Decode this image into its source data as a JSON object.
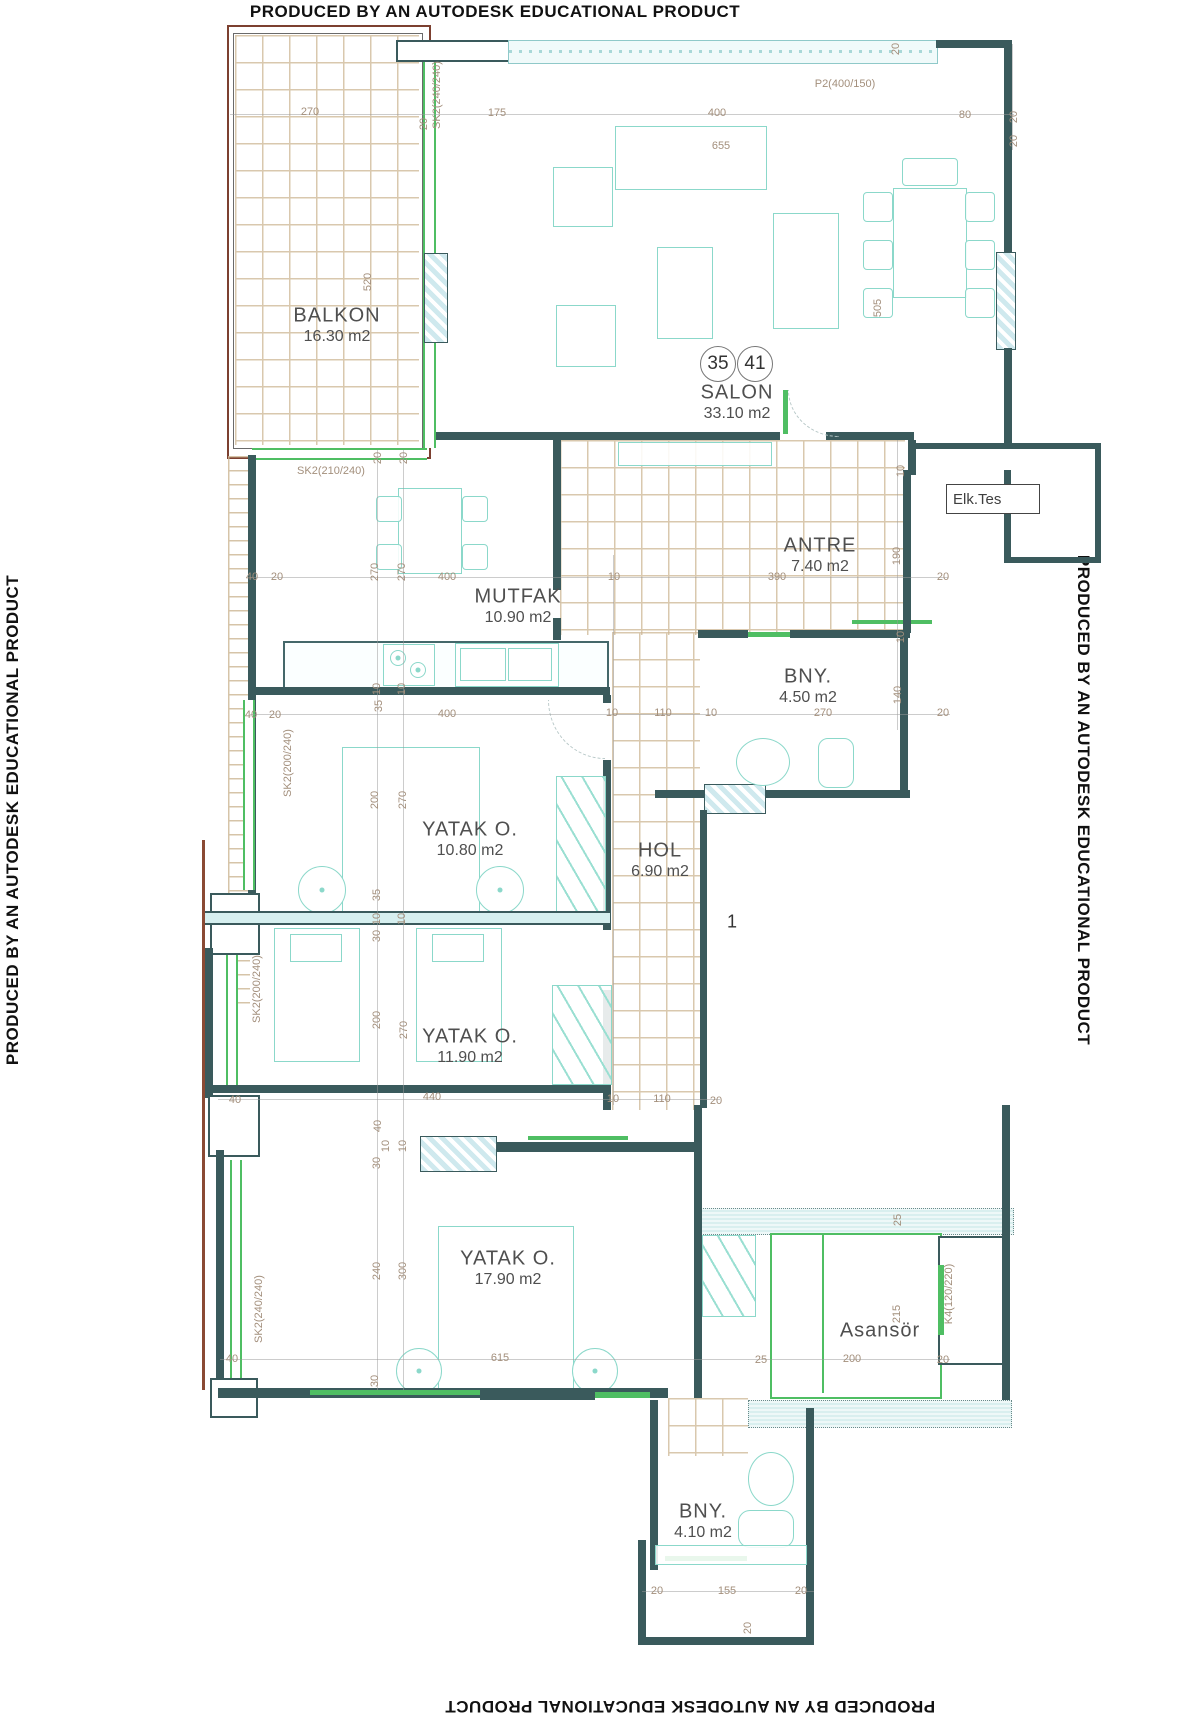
{
  "titles": {
    "top": "PRODUCED BY AN AUTODESK EDUCATIONAL PRODUCT",
    "bottom": "PRODUCED BY AN AUTODESK EDUCATIONAL PRODUCT",
    "left": "PRODUCED BY AN AUTODESK EDUCATIONAL PRODUCT",
    "right": "PRODUCED BY AN AUTODESK EDUCATIONAL PRODUCT"
  },
  "rooms": [
    {
      "name": "BALKON",
      "area": "16.30 m2",
      "x": 337,
      "y": 316
    },
    {
      "name": "SALON",
      "area": "33.10 m2",
      "x": 737,
      "y": 393
    },
    {
      "name": "MUTFAK",
      "area": "10.90 m2",
      "x": 518,
      "y": 597
    },
    {
      "name": "ANTRE",
      "area": "7.40 m2",
      "x": 820,
      "y": 546
    },
    {
      "name": "BNY.",
      "area": "4.50 m2",
      "x": 808,
      "y": 677
    },
    {
      "name": "YATAK O.",
      "area": "10.80 m2",
      "x": 470,
      "y": 830
    },
    {
      "name": "HOL",
      "area": "6.90 m2",
      "x": 660,
      "y": 851
    },
    {
      "name": "YATAK O.",
      "area": "11.90 m2",
      "x": 470,
      "y": 1037
    },
    {
      "name": "YATAK O.",
      "area": "17.90 m2",
      "x": 508,
      "y": 1259
    },
    {
      "name": "Asansör",
      "area": "",
      "x": 880,
      "y": 1331
    },
    {
      "name": "BNY.",
      "area": "4.10 m2",
      "x": 703,
      "y": 1512
    }
  ],
  "unit_circles": [
    {
      "t": "35",
      "x": 718,
      "y": 364
    },
    {
      "t": "41",
      "x": 755,
      "y": 364
    }
  ],
  "labels": {
    "elk_tes": "Elk.Tes",
    "hol_number": "1"
  },
  "dimensions": [
    {
      "t": "270",
      "x": 310,
      "y": 112,
      "v": 0
    },
    {
      "t": "20",
      "x": 424,
      "y": 124,
      "v": 1
    },
    {
      "t": "175",
      "x": 497,
      "y": 113,
      "v": 0
    },
    {
      "t": "400",
      "x": 717,
      "y": 113,
      "v": 0
    },
    {
      "t": "80",
      "x": 965,
      "y": 115,
      "v": 0
    },
    {
      "t": "20",
      "x": 1014,
      "y": 117,
      "v": 1
    },
    {
      "t": "20",
      "x": 1014,
      "y": 141,
      "v": 1
    },
    {
      "t": "655",
      "x": 721,
      "y": 146,
      "v": 0
    },
    {
      "t": "P2(400/150)",
      "x": 845,
      "y": 84,
      "v": 0
    },
    {
      "t": "20",
      "x": 896,
      "y": 49,
      "v": 1
    },
    {
      "t": "SK2(240/240)",
      "x": 437,
      "y": 95,
      "v": 1
    },
    {
      "t": "520",
      "x": 368,
      "y": 282,
      "v": 1
    },
    {
      "t": "505",
      "x": 878,
      "y": 308,
      "v": 1
    },
    {
      "t": "SK2(210/240)",
      "x": 331,
      "y": 471,
      "v": 0
    },
    {
      "t": "20",
      "x": 378,
      "y": 458,
      "v": 1
    },
    {
      "t": "20",
      "x": 404,
      "y": 458,
      "v": 1
    },
    {
      "t": "40",
      "x": 252,
      "y": 577,
      "v": 0
    },
    {
      "t": "20",
      "x": 277,
      "y": 577,
      "v": 0
    },
    {
      "t": "270",
      "x": 375,
      "y": 572,
      "v": 1
    },
    {
      "t": "270",
      "x": 402,
      "y": 572,
      "v": 1
    },
    {
      "t": "400",
      "x": 447,
      "y": 577,
      "v": 0
    },
    {
      "t": "10",
      "x": 614,
      "y": 577,
      "v": 0
    },
    {
      "t": "390",
      "x": 777,
      "y": 577,
      "v": 0
    },
    {
      "t": "20",
      "x": 943,
      "y": 577,
      "v": 0
    },
    {
      "t": "10",
      "x": 901,
      "y": 471,
      "v": 1
    },
    {
      "t": "190",
      "x": 897,
      "y": 556,
      "v": 1
    },
    {
      "t": "40",
      "x": 251,
      "y": 715,
      "v": 0
    },
    {
      "t": "20",
      "x": 275,
      "y": 715,
      "v": 0
    },
    {
      "t": "10",
      "x": 377,
      "y": 689,
      "v": 1
    },
    {
      "t": "10",
      "x": 402,
      "y": 689,
      "v": 1
    },
    {
      "t": "35",
      "x": 379,
      "y": 706,
      "v": 1
    },
    {
      "t": "400",
      "x": 447,
      "y": 714,
      "v": 0
    },
    {
      "t": "10",
      "x": 612,
      "y": 713,
      "v": 0
    },
    {
      "t": "110",
      "x": 663,
      "y": 713,
      "v": 0
    },
    {
      "t": "10",
      "x": 711,
      "y": 713,
      "v": 0
    },
    {
      "t": "270",
      "x": 823,
      "y": 713,
      "v": 0
    },
    {
      "t": "20",
      "x": 943,
      "y": 713,
      "v": 0
    },
    {
      "t": "10",
      "x": 901,
      "y": 637,
      "v": 1
    },
    {
      "t": "140",
      "x": 898,
      "y": 695,
      "v": 1
    },
    {
      "t": "SK2(200/240)",
      "x": 288,
      "y": 763,
      "v": 1
    },
    {
      "t": "200",
      "x": 375,
      "y": 800,
      "v": 1
    },
    {
      "t": "270",
      "x": 403,
      "y": 800,
      "v": 1
    },
    {
      "t": "35",
      "x": 377,
      "y": 895,
      "v": 1
    },
    {
      "t": "10",
      "x": 377,
      "y": 919,
      "v": 1
    },
    {
      "t": "10",
      "x": 402,
      "y": 919,
      "v": 1
    },
    {
      "t": "30",
      "x": 377,
      "y": 936,
      "v": 1
    },
    {
      "t": "SK2(200/240)",
      "x": 257,
      "y": 989,
      "v": 1
    },
    {
      "t": "200",
      "x": 377,
      "y": 1020,
      "v": 1
    },
    {
      "t": "270",
      "x": 404,
      "y": 1030,
      "v": 1
    },
    {
      "t": "40",
      "x": 235,
      "y": 1100,
      "v": 0
    },
    {
      "t": "440",
      "x": 432,
      "y": 1097,
      "v": 0
    },
    {
      "t": "10",
      "x": 613,
      "y": 1099,
      "v": 0
    },
    {
      "t": "110",
      "x": 662,
      "y": 1099,
      "v": 0
    },
    {
      "t": "20",
      "x": 716,
      "y": 1101,
      "v": 0
    },
    {
      "t": "40",
      "x": 378,
      "y": 1126,
      "v": 1
    },
    {
      "t": "10",
      "x": 386,
      "y": 1146,
      "v": 1
    },
    {
      "t": "10",
      "x": 403,
      "y": 1146,
      "v": 1
    },
    {
      "t": "30",
      "x": 377,
      "y": 1163,
      "v": 1
    },
    {
      "t": "240",
      "x": 377,
      "y": 1271,
      "v": 1
    },
    {
      "t": "300",
      "x": 403,
      "y": 1271,
      "v": 1
    },
    {
      "t": "SK2(240/240)",
      "x": 259,
      "y": 1309,
      "v": 1
    },
    {
      "t": "40",
      "x": 232,
      "y": 1359,
      "v": 0
    },
    {
      "t": "615",
      "x": 500,
      "y": 1358,
      "v": 0
    },
    {
      "t": "30",
      "x": 375,
      "y": 1381,
      "v": 1
    },
    {
      "t": "25",
      "x": 898,
      "y": 1220,
      "v": 1
    },
    {
      "t": "215",
      "x": 897,
      "y": 1314,
      "v": 1
    },
    {
      "t": "K4(120/220)",
      "x": 949,
      "y": 1294,
      "v": 1
    },
    {
      "t": "25",
      "x": 761,
      "y": 1360,
      "v": 0
    },
    {
      "t": "200",
      "x": 852,
      "y": 1359,
      "v": 0
    },
    {
      "t": "20",
      "x": 943,
      "y": 1360,
      "v": 0
    },
    {
      "t": "20",
      "x": 657,
      "y": 1591,
      "v": 0
    },
    {
      "t": "155",
      "x": 727,
      "y": 1591,
      "v": 0
    },
    {
      "t": "20",
      "x": 801,
      "y": 1591,
      "v": 0
    },
    {
      "t": "20",
      "x": 748,
      "y": 1628,
      "v": 1
    }
  ],
  "colors": {
    "wall": "#3a5a5c",
    "furniture": "#8bd8ca",
    "tile": "#cdb693",
    "dim_text": "#a38f7c",
    "green": "#4fbe63",
    "hatch_cyan": "#d6eef2",
    "brown": "#7c4030"
  }
}
